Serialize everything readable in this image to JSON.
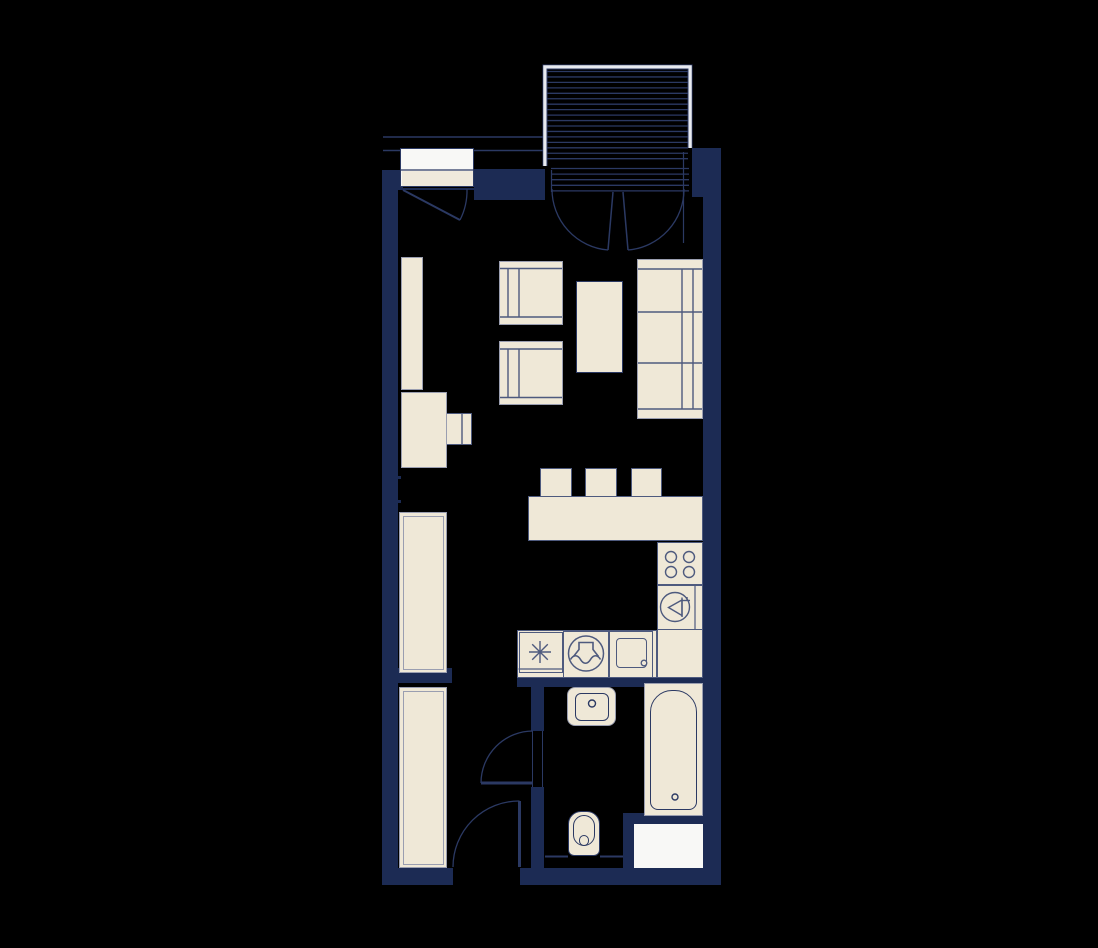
{
  "meta": {
    "type": "apartment-floor-plan",
    "canvas_w": 1098,
    "canvas_h": 948
  },
  "palette": {
    "bg": "#000000",
    "wall": "#1c2b54",
    "cream": "#efe8d7",
    "cream_dim": "#efe9dc",
    "white": "#f8f8f6",
    "line_navy": "#2b3963",
    "line_slate": "#4e5a7e",
    "border_gray": "#9a9eb0",
    "frame_light": "#e8eaf0"
  },
  "walls": [
    {
      "name": "wall-left",
      "x": 382,
      "y": 170,
      "w": 16,
      "h": 715
    },
    {
      "name": "wall-top-left-corner",
      "x": 382,
      "y": 170,
      "w": 21,
      "h": 20
    },
    {
      "name": "wall-under-entry-door",
      "x": 403,
      "y": 187.5,
      "w": 71,
      "h": 2.5
    },
    {
      "name": "wall-entry-block",
      "x": 474,
      "y": 169,
      "w": 71,
      "h": 31
    },
    {
      "name": "wall-top-right",
      "x": 692,
      "y": 148,
      "w": 29,
      "h": 49
    },
    {
      "name": "wall-right",
      "x": 703,
      "y": 197,
      "w": 18,
      "h": 688
    },
    {
      "name": "wall-kitchen-bath-divider",
      "x": 517,
      "y": 676,
      "w": 186,
      "h": 11
    },
    {
      "name": "wall-bath-west-upper",
      "x": 531,
      "y": 687,
      "w": 13,
      "h": 44
    },
    {
      "name": "wall-bath-west-lower",
      "x": 531,
      "y": 787,
      "w": 13,
      "h": 81
    },
    {
      "name": "wall-closet-stub",
      "x": 396,
      "y": 668,
      "w": 56,
      "h": 15
    },
    {
      "name": "wall-bottom-left",
      "x": 382,
      "y": 868,
      "w": 71,
      "h": 17
    },
    {
      "name": "wall-bottom-right",
      "x": 520,
      "y": 868,
      "w": 200,
      "h": 17
    },
    {
      "name": "wall-appliance-surround",
      "x": 623,
      "y": 813,
      "w": 80,
      "h": 55
    },
    {
      "name": "wall-nib-upper",
      "x": 396,
      "y": 476,
      "w": 5,
      "h": 3
    },
    {
      "name": "wall-nib-lower",
      "x": 396,
      "y": 500,
      "w": 5,
      "h": 3
    }
  ],
  "rects": [
    {
      "name": "shelf-tall",
      "x": 401,
      "y": 257,
      "w": 22,
      "h": 133,
      "fill": "cream",
      "stroke": "border_gray",
      "sw": 1.5
    },
    {
      "name": "desk-chair",
      "x": 439,
      "y": 413,
      "w": 33,
      "h": 32,
      "fill": "cream",
      "stroke": "line_slate",
      "sw": 1.5
    },
    {
      "name": "desk",
      "x": 401,
      "y": 392,
      "w": 46,
      "h": 76,
      "fill": "cream",
      "stroke": "border_gray",
      "sw": 1.5
    },
    {
      "name": "armchair-1",
      "x": 499,
      "y": 261,
      "w": 64,
      "h": 64,
      "fill": "cream",
      "stroke": "border_gray",
      "sw": 1.5
    },
    {
      "name": "armchair-2",
      "x": 499,
      "y": 341,
      "w": 64,
      "h": 64,
      "fill": "cream",
      "stroke": "border_gray",
      "sw": 1.5
    },
    {
      "name": "coffee-table",
      "x": 576,
      "y": 281,
      "w": 47,
      "h": 92,
      "fill": "cream",
      "stroke": "line_navy",
      "sw": 1.5
    },
    {
      "name": "sofa",
      "x": 637,
      "y": 259,
      "w": 66,
      "h": 160,
      "fill": "cream",
      "stroke": "border_gray",
      "sw": 1.5
    },
    {
      "name": "bar-stool-1",
      "x": 540,
      "y": 468,
      "w": 32,
      "h": 29,
      "fill": "cream",
      "stroke": "line_slate",
      "sw": 1.5
    },
    {
      "name": "bar-stool-2",
      "x": 585,
      "y": 468,
      "w": 32,
      "h": 29,
      "fill": "cream",
      "stroke": "line_slate",
      "sw": 1.5
    },
    {
      "name": "bar-stool-3",
      "x": 631,
      "y": 468,
      "w": 31,
      "h": 29,
      "fill": "cream",
      "stroke": "line_slate",
      "sw": 1.5
    },
    {
      "name": "bar-counter",
      "x": 528,
      "y": 496,
      "w": 175,
      "h": 45,
      "fill": "cream",
      "stroke": "line_slate",
      "sw": 1.5
    },
    {
      "name": "kitchen-cabinet-tall",
      "x": 399,
      "y": 512,
      "w": 48,
      "h": 161,
      "fill": "cream",
      "stroke": "border_gray",
      "sw": 1.5,
      "inner": true
    },
    {
      "name": "kitchen-counter-bottom",
      "x": 517,
      "y": 630,
      "w": 140,
      "h": 48,
      "fill": "cream",
      "stroke": "line_slate",
      "sw": 1.5
    },
    {
      "name": "kitchen-counter-right",
      "x": 657,
      "y": 542,
      "w": 46,
      "h": 136,
      "fill": "cream",
      "stroke": "line_slate",
      "sw": 1.5
    },
    {
      "name": "cell-star",
      "x": 518.5,
      "y": 632,
      "w": 44.5,
      "h": 41,
      "stroke": "line_slate",
      "sw": 1.2
    },
    {
      "name": "cell-washer",
      "x": 563,
      "y": 630.5,
      "w": 46,
      "h": 47,
      "stroke": "line_slate",
      "sw": 1.2
    },
    {
      "name": "cell-sink",
      "x": 609,
      "y": 630.5,
      "w": 44,
      "h": 47,
      "stroke": "line_slate",
      "sw": 1.2
    },
    {
      "name": "sink-basin-inner",
      "x": 616,
      "y": 638,
      "w": 31,
      "h": 30,
      "stroke": "line_slate",
      "sw": 1.5,
      "r": 4
    },
    {
      "name": "cell-hob",
      "x": 657,
      "y": 542,
      "w": 46,
      "h": 43,
      "stroke": "line_slate",
      "sw": 1.2
    },
    {
      "name": "cell-dishwasher",
      "x": 657,
      "y": 585,
      "w": 46,
      "h": 45,
      "stroke": "line_slate",
      "sw": 1.2
    },
    {
      "name": "bath-sink-outer",
      "x": 567,
      "y": 687,
      "w": 49,
      "h": 39,
      "fill": "cream",
      "stroke": "border_gray",
      "sw": 1,
      "r": 8
    },
    {
      "name": "bath-sink-inner",
      "x": 575,
      "y": 692.5,
      "w": 34,
      "h": 28,
      "stroke": "line_navy",
      "sw": 1.5,
      "r": 6
    },
    {
      "name": "toilet-outer",
      "x": 568,
      "y": 811,
      "w": 32,
      "h": 45,
      "fill": "cream",
      "stroke": "line_navy",
      "sw": 1.5,
      "r": "13px 13px 6px 6px"
    },
    {
      "name": "toilet-bowl",
      "x": 573,
      "y": 815,
      "w": 22,
      "h": 31,
      "stroke": "line_navy",
      "sw": 1.5,
      "r": 11
    },
    {
      "name": "toilet-drain",
      "x": 579,
      "y": 835,
      "w": 10,
      "h": 11,
      "stroke": "line_navy",
      "sw": 1.5,
      "r": 5
    },
    {
      "name": "bathtub-outer",
      "x": 644,
      "y": 683,
      "w": 59,
      "h": 133,
      "fill": "cream",
      "stroke": "border_gray",
      "sw": 1.5
    },
    {
      "name": "bathtub-inner",
      "x": 650,
      "y": 690,
      "w": 47,
      "h": 120,
      "stroke": "line_navy",
      "sw": 1.5,
      "r": "22px 22px 8px 8px"
    },
    {
      "name": "appliance-white-box",
      "x": 634,
      "y": 824,
      "w": 69,
      "h": 44,
      "fill": "white"
    },
    {
      "name": "hall-wardrobe",
      "x": 399,
      "y": 687,
      "w": 48,
      "h": 181,
      "fill": "cream",
      "stroke": "border_gray",
      "sw": 1.5,
      "inner": true
    },
    {
      "name": "entry-door-panel",
      "x": 400,
      "y": 148,
      "w": 74,
      "h": 39,
      "fill": "white",
      "stroke": "line_navy",
      "sw": 1.5
    },
    {
      "name": "entry-door-panel-lower",
      "x": 401.5,
      "y": 171,
      "w": 71,
      "h": 15,
      "fill": "cream_dim"
    }
  ],
  "svg": {
    "hatch": [
      {
        "name": "balcony-deck-hatch",
        "x1": 546.5,
        "x2": 688,
        "y1": 71.5,
        "y2": 163.5,
        "step": 5.45,
        "c": "line_navy",
        "w": 1.3
      },
      {
        "name": "balcony-threshold-hatch",
        "x1": 551,
        "x2": 689,
        "y1": 168.5,
        "y2": 191.5,
        "step": 5.6,
        "c": "line_navy",
        "w": 1.3
      }
    ],
    "lines": [
      {
        "name": "walkway-edge-outer",
        "x1": 383,
        "y1": 137,
        "x2": 543,
        "y2": 137,
        "c": "line_navy",
        "w": 1.5
      },
      {
        "name": "walkway-edge-inner-left",
        "x1": 383,
        "y1": 150.5,
        "x2": 400,
        "y2": 150.5,
        "c": "line_navy",
        "w": 1.5
      },
      {
        "name": "walkway-edge-inner-right",
        "x1": 474,
        "y1": 150.5,
        "x2": 543,
        "y2": 150.5,
        "c": "line_navy",
        "w": 1.5
      },
      {
        "name": "entry-door-divider",
        "x1": 400,
        "y1": 170,
        "x2": 474,
        "y2": 170,
        "c": "line_navy",
        "w": 1.2
      },
      {
        "name": "armchair1-back-top",
        "x1": 500,
        "y1": 268.5,
        "x2": 562,
        "y2": 268.5,
        "c": "line_slate",
        "w": 1.4
      },
      {
        "name": "armchair1-back-bottom",
        "x1": 500,
        "y1": 317,
        "x2": 562,
        "y2": 317,
        "c": "line_slate",
        "w": 1.4
      },
      {
        "name": "armchair1-arm-1",
        "x1": 508,
        "y1": 268.5,
        "x2": 508,
        "y2": 317,
        "c": "line_slate",
        "w": 1.4
      },
      {
        "name": "armchair1-arm-2",
        "x1": 519,
        "y1": 268.5,
        "x2": 519,
        "y2": 317,
        "c": "line_slate",
        "w": 1.4
      },
      {
        "name": "armchair2-back-top",
        "x1": 500,
        "y1": 349,
        "x2": 562,
        "y2": 349,
        "c": "line_slate",
        "w": 1.4
      },
      {
        "name": "armchair2-back-bottom",
        "x1": 500,
        "y1": 397.5,
        "x2": 562,
        "y2": 397.5,
        "c": "line_slate",
        "w": 1.4
      },
      {
        "name": "armchair2-arm-1",
        "x1": 508,
        "y1": 349,
        "x2": 508,
        "y2": 397.5,
        "c": "line_slate",
        "w": 1.4
      },
      {
        "name": "armchair2-arm-2",
        "x1": 519,
        "y1": 349,
        "x2": 519,
        "y2": 397.5,
        "c": "line_slate",
        "w": 1.4
      },
      {
        "name": "sofa-arm-top",
        "x1": 638,
        "y1": 269,
        "x2": 702,
        "y2": 269,
        "c": "line_slate",
        "w": 1.4
      },
      {
        "name": "sofa-arm-bottom",
        "x1": 638,
        "y1": 409,
        "x2": 702,
        "y2": 409,
        "c": "line_slate",
        "w": 1.4
      },
      {
        "name": "sofa-cushion-1",
        "x1": 638,
        "y1": 312,
        "x2": 702,
        "y2": 312,
        "c": "line_slate",
        "w": 1.4
      },
      {
        "name": "sofa-cushion-2",
        "x1": 638,
        "y1": 363,
        "x2": 702,
        "y2": 363,
        "c": "line_slate",
        "w": 1.4
      },
      {
        "name": "sofa-back-1",
        "x1": 682,
        "y1": 269,
        "x2": 682,
        "y2": 409,
        "c": "line_slate",
        "w": 1.4
      },
      {
        "name": "sofa-back-2",
        "x1": 693,
        "y1": 269,
        "x2": 693,
        "y2": 409,
        "c": "line_slate",
        "w": 1.4
      },
      {
        "name": "desk-chair-back",
        "x1": 462,
        "y1": 414,
        "x2": 462,
        "y2": 444,
        "c": "line_slate",
        "w": 1.4
      },
      {
        "name": "cell-star-base",
        "x1": 518.5,
        "y1": 669,
        "x2": 563,
        "y2": 669,
        "c": "line_slate",
        "w": 1.2
      },
      {
        "name": "dishwasher-divider",
        "x1": 695,
        "y1": 585,
        "x2": 695,
        "y2": 630,
        "c": "line_slate",
        "w": 1.2
      },
      {
        "name": "star-spoke-h",
        "x1": 529,
        "y1": 652,
        "x2": 551,
        "y2": 652,
        "c": "line_slate",
        "w": 1.4
      },
      {
        "name": "star-spoke-v",
        "x1": 540,
        "y1": 641,
        "x2": 540,
        "y2": 663,
        "c": "line_slate",
        "w": 1.4
      },
      {
        "name": "star-spoke-d1",
        "x1": 532.2,
        "y1": 644.2,
        "x2": 547.8,
        "y2": 659.8,
        "c": "line_slate",
        "w": 1.4
      },
      {
        "name": "star-spoke-d2",
        "x1": 532.2,
        "y1": 659.8,
        "x2": 547.8,
        "y2": 644.2,
        "c": "line_slate",
        "w": 1.4
      },
      {
        "name": "dw-glyph-pole",
        "x1": 682,
        "y1": 597.5,
        "x2": 682,
        "y2": 617,
        "c": "line_slate",
        "w": 1.4
      },
      {
        "name": "dw-glyph-bar",
        "x1": 682,
        "y1": 600.5,
        "x2": 690,
        "y2": 600.5,
        "c": "line_slate",
        "w": 1.4
      },
      {
        "name": "dw-glyph-notch",
        "x1": 687,
        "y1": 597,
        "x2": 687,
        "y2": 600.5,
        "c": "line_slate",
        "w": 1.4
      },
      {
        "name": "toilet-ledge-left",
        "x1": 545,
        "y1": 856.5,
        "x2": 568,
        "y2": 856.5,
        "c": "line_navy",
        "w": 2
      },
      {
        "name": "toilet-ledge-right",
        "x1": 600,
        "y1": 856.5,
        "x2": 623,
        "y2": 856.5,
        "c": "line_navy",
        "w": 2
      },
      {
        "name": "bath-door-jamb-1",
        "x1": 532.5,
        "y1": 731,
        "x2": 532.5,
        "y2": 787,
        "c": "line_navy",
        "w": 1
      },
      {
        "name": "bath-door-jamb-2",
        "x1": 542.5,
        "y1": 731,
        "x2": 542.5,
        "y2": 787,
        "c": "line_navy",
        "w": 1
      },
      {
        "name": "balcony-jamb-left",
        "x1": 551.5,
        "y1": 170,
        "x2": 551.5,
        "y2": 192,
        "c": "line_navy",
        "w": 1.2
      },
      {
        "name": "balcony-jamb-right",
        "x1": 683.5,
        "y1": 152,
        "x2": 683.5,
        "y2": 243,
        "c": "line_navy",
        "w": 1.2
      },
      {
        "name": "french-door-leaf-left",
        "x1": 613,
        "y1": 192,
        "x2": 608,
        "y2": 250,
        "c": "line_navy",
        "w": 1.5
      },
      {
        "name": "french-door-leaf-right",
        "x1": 623,
        "y1": 192,
        "x2": 628,
        "y2": 250,
        "c": "line_navy",
        "w": 1.5
      },
      {
        "name": "entry-door-leaf",
        "x1": 403,
        "y1": 190,
        "x2": 460,
        "y2": 220,
        "c": "line_navy",
        "w": 2
      },
      {
        "name": "bath-door-leaf",
        "x1": 481,
        "y1": 783,
        "x2": 533,
        "y2": 783,
        "c": "line_navy",
        "w": 3
      },
      {
        "name": "hall-door-leaf",
        "x1": 519.5,
        "y1": 801,
        "x2": 519.5,
        "y2": 867,
        "c": "line_navy",
        "w": 3
      }
    ],
    "paths": [
      {
        "name": "balcony-railing-outer",
        "d": "M 543,166 L 543,65 L 692,65 L 692,148",
        "c": "line_navy",
        "w": 1
      },
      {
        "name": "balcony-railing-band",
        "d": "M 545,166 L 545,67 L 690,67 L 690,148",
        "c": "frame_light",
        "w": 3.5
      },
      {
        "name": "balcony-railing-inner",
        "d": "M 547,166 L 547,69 L 688,69 L 688,148",
        "c": "line_navy",
        "w": 1
      },
      {
        "name": "entry-door-arc",
        "d": "M 460,220 A 65,65 0 0 0 467,189",
        "c": "line_navy",
        "w": 1.3
      },
      {
        "name": "french-door-arc-left",
        "d": "M 552,189 A 61,61 0 0 0 608,250",
        "c": "line_navy",
        "w": 1.3
      },
      {
        "name": "french-door-arc-right",
        "d": "M 684,189 A 61,61 0 0 1 628,250",
        "c": "line_navy",
        "w": 1.3
      },
      {
        "name": "bath-door-arc",
        "d": "M 481,783 A 52,52 0 0 1 533,731",
        "c": "line_navy",
        "w": 1.3
      },
      {
        "name": "hall-door-arc",
        "d": "M 519.5,801 A 66,66 0 0 0 453,867",
        "c": "line_navy",
        "w": 1.3
      },
      {
        "name": "washer-glyph-hood",
        "d": "M 573.5,656.5 L 579,649.5 L 579,642.5 L 593,642.5 L 593,649.5 L 598.5,656.5",
        "c": "line_slate",
        "w": 1.6
      },
      {
        "name": "washer-glyph-wave",
        "d": "M 570.5,659.5 C 573.5,654.5 577.5,654.5 580.5,659.5 C 583.5,664.5 587.5,664.5 590.5,659.5 C 593.5,654.5 597.5,654.5 600.5,659.5",
        "c": "line_slate",
        "w": 1.6
      },
      {
        "name": "dw-glyph-funnel",
        "d": "M 682,600 L 682,615.5 L 668.5,607.5 Z",
        "c": "line_slate",
        "w": 1.4
      }
    ],
    "circles": [
      {
        "name": "hob-burner-1",
        "cx": 671,
        "cy": 557,
        "r": 5.5,
        "c": "line_slate",
        "w": 1.4
      },
      {
        "name": "hob-burner-2",
        "cx": 689,
        "cy": 557,
        "r": 5.5,
        "c": "line_slate",
        "w": 1.4
      },
      {
        "name": "hob-burner-3",
        "cx": 671,
        "cy": 572,
        "r": 5.5,
        "c": "line_slate",
        "w": 1.4
      },
      {
        "name": "hob-burner-4",
        "cx": 689,
        "cy": 572,
        "r": 5.5,
        "c": "line_slate",
        "w": 1.4
      },
      {
        "name": "dishwasher-circle",
        "cx": 675,
        "cy": 607,
        "r": 14.5,
        "c": "line_slate",
        "w": 1.4
      },
      {
        "name": "washer-circle",
        "cx": 586,
        "cy": 653.5,
        "r": 17.5,
        "c": "line_slate",
        "w": 1.5
      },
      {
        "name": "kitchen-sink-drain",
        "cx": 644,
        "cy": 663,
        "r": 2.8,
        "c": "line_slate",
        "w": 1.3
      },
      {
        "name": "bath-sink-drain",
        "cx": 592,
        "cy": 703.5,
        "r": 3.5,
        "c": "line_navy",
        "w": 1.4
      },
      {
        "name": "bathtub-drain",
        "cx": 675,
        "cy": 797,
        "r": 3,
        "c": "line_navy",
        "w": 1.4
      }
    ]
  }
}
